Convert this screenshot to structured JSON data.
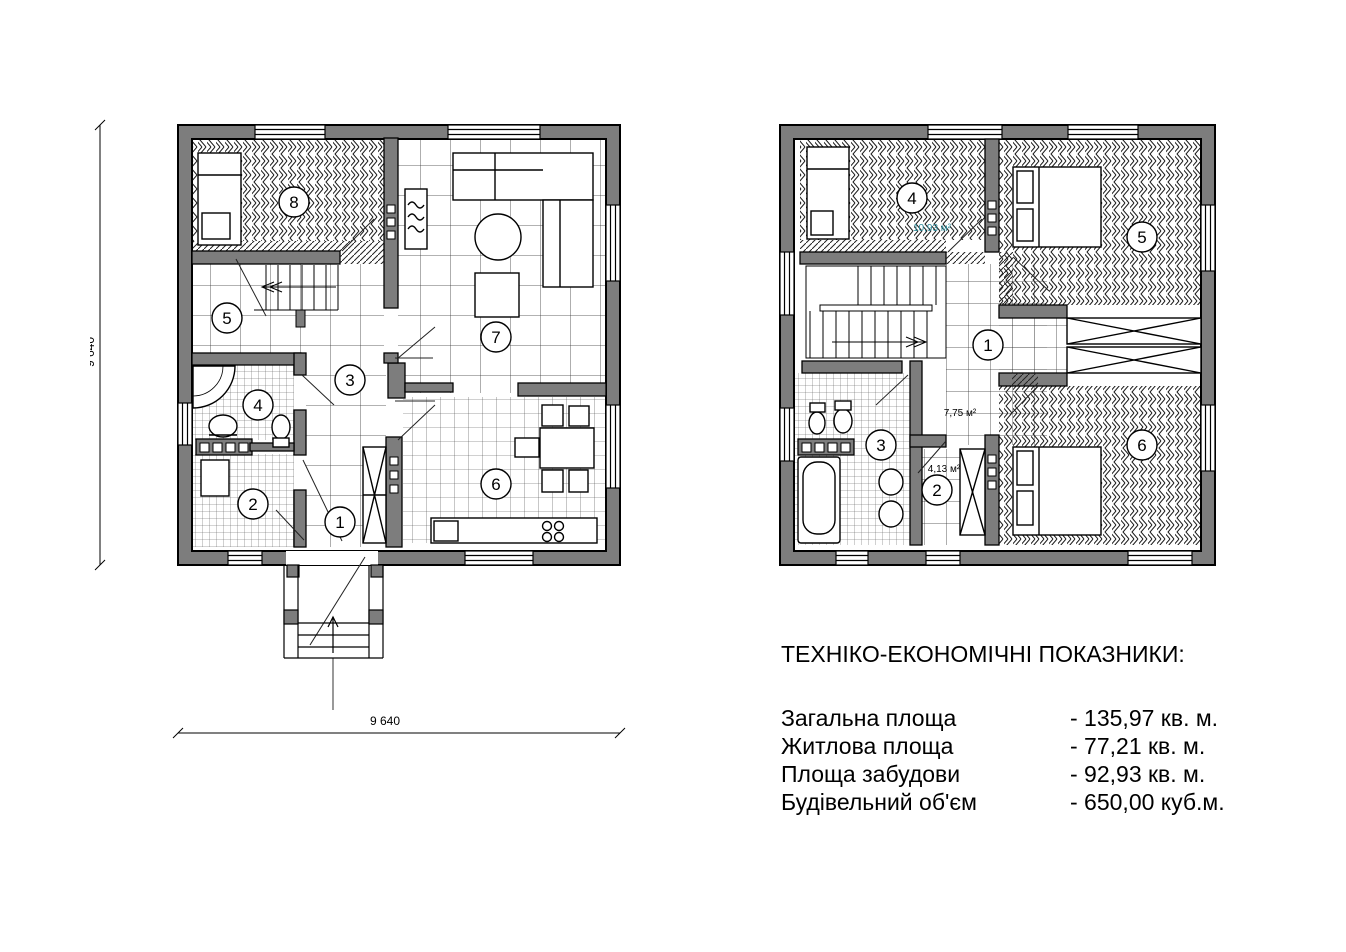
{
  "indicators": {
    "title": "ТЕХНІКО-ЕКОНОМІЧНІ ПОКАЗНИКИ:",
    "rows": [
      {
        "label": "Загальна площа",
        "value": "- 135,97 кв. м."
      },
      {
        "label": "Житлова площа",
        "value": "- 77,21 кв. м."
      },
      {
        "label": "Площа забудови",
        "value": "- 92,93 кв. м."
      },
      {
        "label": "Будівельний об'єм",
        "value": "- 650,00 куб.м."
      }
    ]
  },
  "first_floor": {
    "dimension_left": "9 640",
    "dimension_bottom": "9 640",
    "rooms": {
      "n1": "1",
      "n2": "2",
      "n3": "3",
      "n4": "4",
      "n5": "5",
      "n6": "6",
      "n7": "7",
      "n8": "8"
    }
  },
  "second_floor": {
    "rooms": {
      "n1": "1",
      "n2": "2",
      "n3": "3",
      "n4": "4",
      "n5": "5",
      "n6": "6"
    },
    "areas": {
      "hall": "7,75 м²",
      "closet": "4,13 м²",
      "bedroom4": "10,93 м²"
    }
  },
  "colors": {
    "wall": "#7d7d7d",
    "line": "#000000",
    "area_accent": "#2e8b9a",
    "background": "#ffffff"
  }
}
